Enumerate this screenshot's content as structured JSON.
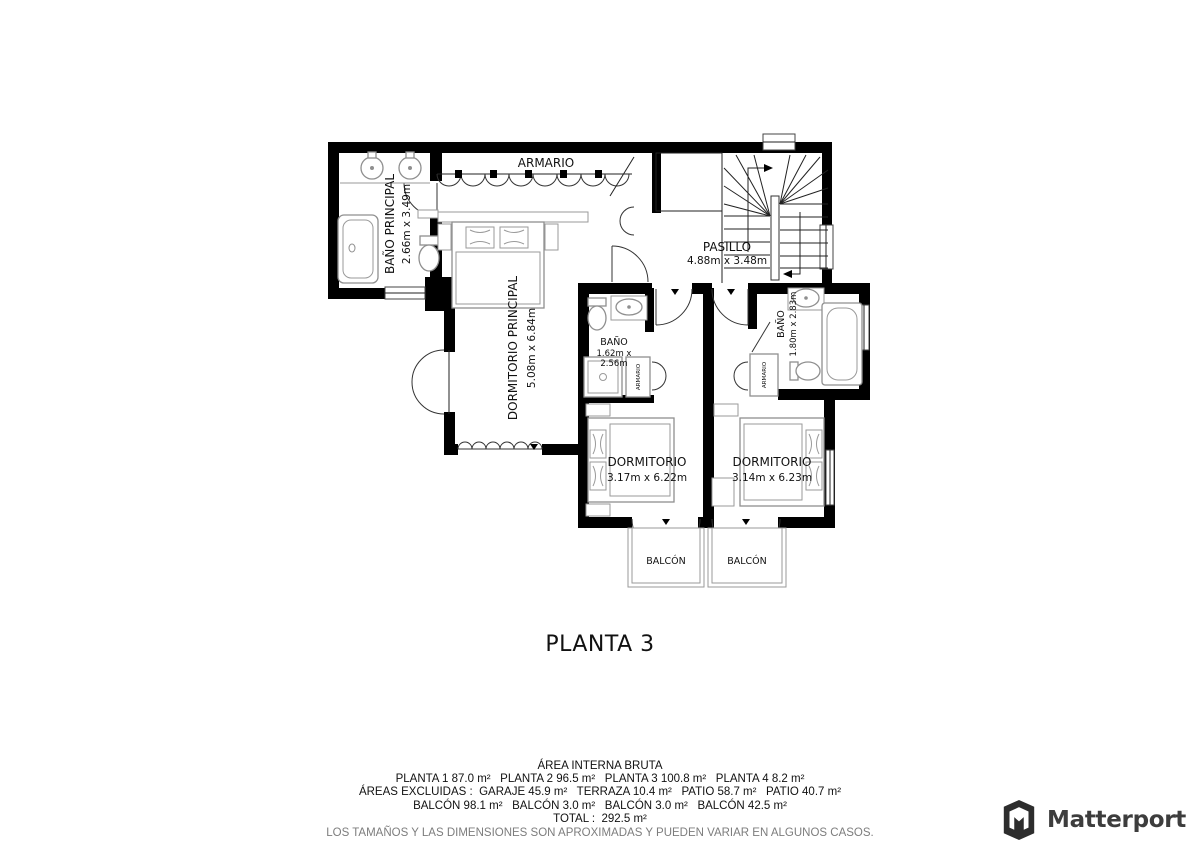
{
  "plan": {
    "title": "PLANTA 3",
    "rooms": {
      "bano_principal": {
        "name": "BAÑO PRINCIPAL",
        "dims": "2.66m x 3.49m"
      },
      "armario_top": {
        "name": "ARMARIO"
      },
      "dormitorio_principal": {
        "name": "DORMITORIO PRINCIPAL",
        "dims": "5.08m x 6.84m"
      },
      "pasillo": {
        "name": "PASILLO",
        "dims": "4.88m x 3.48m"
      },
      "bano_1": {
        "name": "BAÑO",
        "dims_l1": "1.62m x",
        "dims_l2": "2.56m"
      },
      "armario_1": {
        "name": "ARMARIO"
      },
      "dormitorio_1": {
        "name": "DORMITORIO",
        "dims": "3.17m x 6.22m"
      },
      "bano_2": {
        "name": "BAÑO",
        "dims": "1.80m x 2.83m"
      },
      "armario_2": {
        "name": "ARMARIO"
      },
      "dormitorio_2": {
        "name": "DORMITORIO",
        "dims": "3.14m x 6.23m"
      },
      "balcon_1": {
        "name": "BALCÓN"
      },
      "balcon_2": {
        "name": "BALCÓN"
      }
    }
  },
  "summary": {
    "heading": "ÁREA INTERNA BRUTA",
    "line_plantas": "PLANTA 1 87.0 m²   PLANTA 2 96.5 m²   PLANTA 3 100.8 m²   PLANTA 4 8.2 m²",
    "line_excluidas": "ÁREAS EXCLUIDAS :  GARAJE 45.9 m²   TERRAZA 10.4 m²   PATIO 58.7 m²   PATIO 40.7 m²",
    "line_balcones": "BALCÓN 98.1 m²   BALCÓN 3.0 m²   BALCÓN 3.0 m²   BALCÓN 42.5 m²",
    "line_total": "TOTAL :  292.5 m²",
    "disclaimer": "LOS TAMAÑOS Y LAS DIMENSIONES SON APROXIMADAS Y PUEDEN VARIAR EN ALGUNOS CASOS."
  },
  "branding": {
    "logo_text": "Matterport",
    "logo_icon": "matterport-cube-icon"
  },
  "colors": {
    "background": "#ffffff",
    "wall": "#000000",
    "furniture_stroke": "#8f8f8f",
    "text": "#111111",
    "muted_text": "#7d7d7d",
    "logo": "#3d3d3d"
  }
}
